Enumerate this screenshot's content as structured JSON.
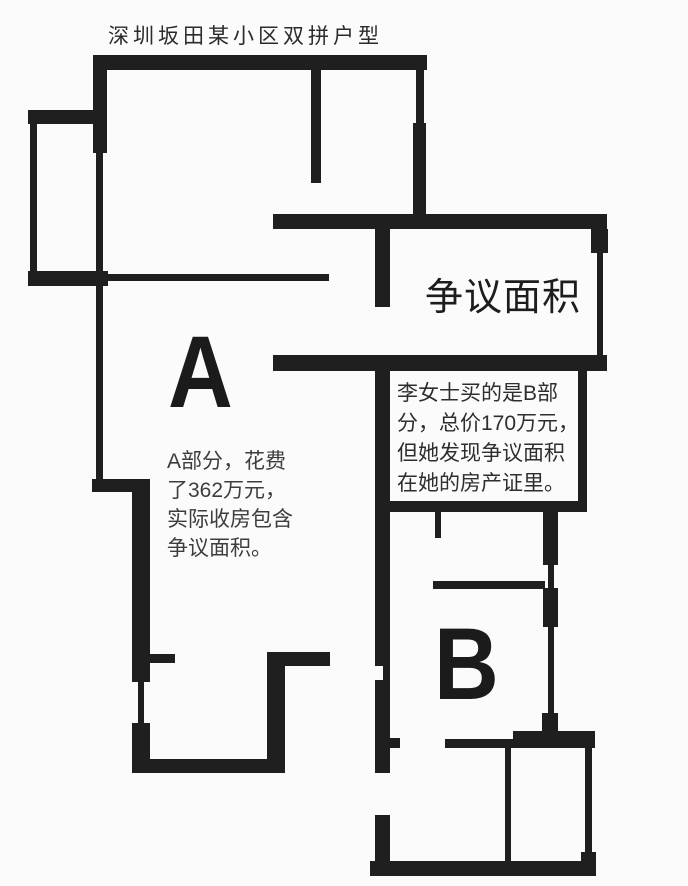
{
  "page": {
    "background": "#fbfbfb",
    "wall_color": "#1f1f1f"
  },
  "title": "深圳坂田某小区双拼户型",
  "plan": {
    "unit_a": {
      "label": "A",
      "note_lines": [
        "A部分，花费",
        "了362万元，",
        "实际收房包含",
        "争议面积。"
      ]
    },
    "unit_b": {
      "label": "B",
      "note_lines": [
        "李女士买的是B部",
        "分，总价170万元，",
        "但她发现争议面积",
        "在她的房产证里。"
      ]
    },
    "disputed_area": {
      "label": "争议面积"
    }
  }
}
